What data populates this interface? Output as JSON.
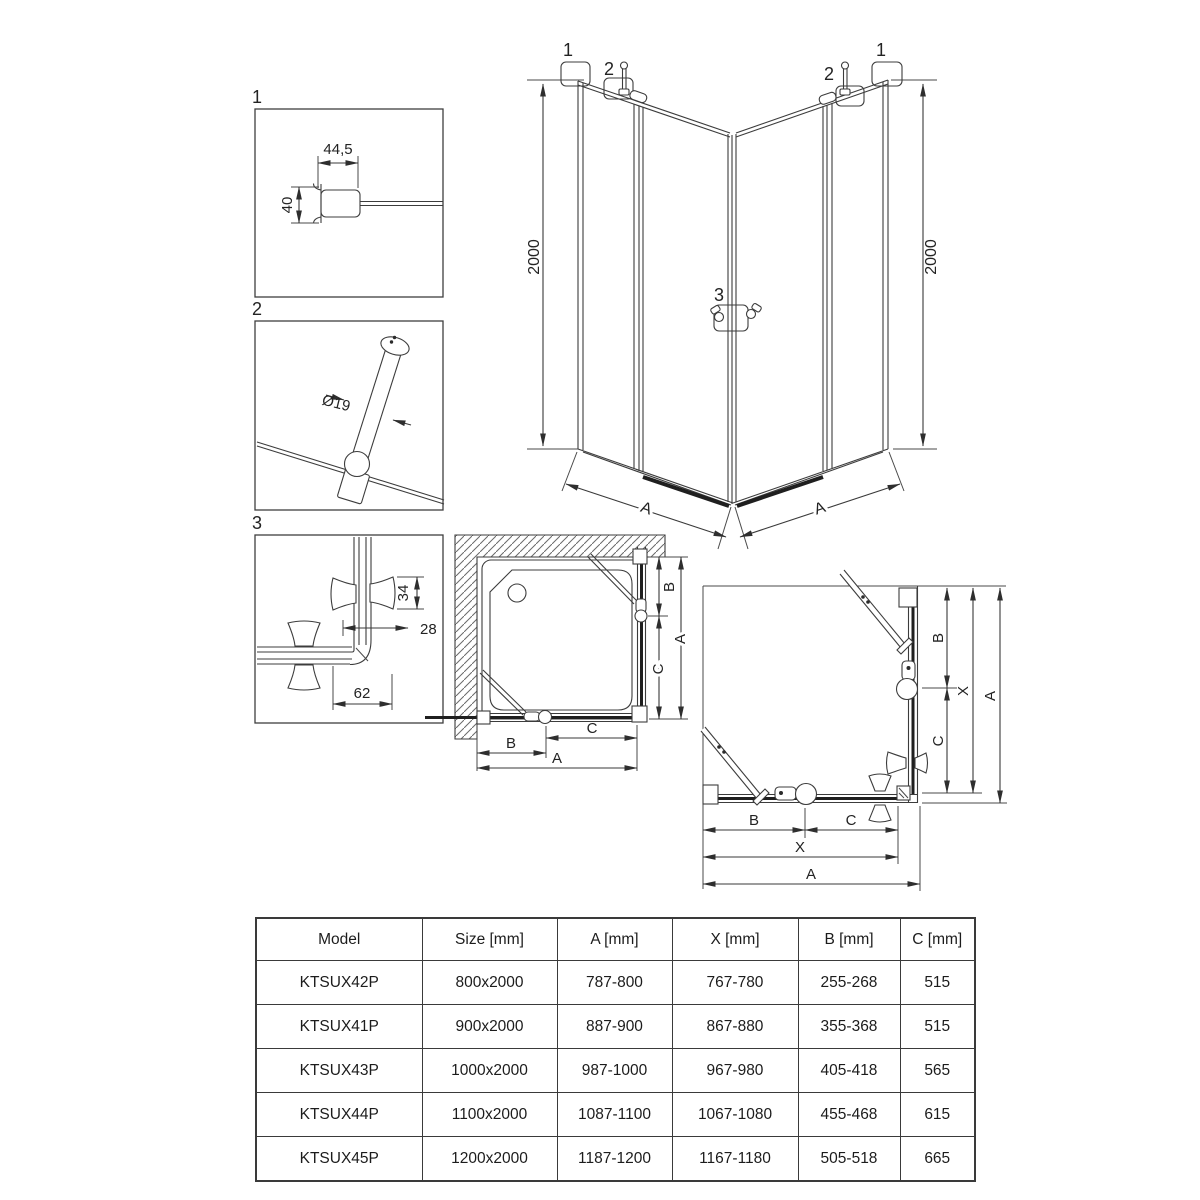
{
  "drawing": {
    "detail_1": {
      "callout": "1",
      "dim_width": "44,5",
      "dim_height": "40"
    },
    "detail_2": {
      "callout": "2",
      "dim_diameter": "Ø19"
    },
    "detail_3": {
      "callout": "3",
      "dim_height": "34",
      "dim_offset": "28",
      "dim_width": "62"
    },
    "elevation": {
      "dim_height_left": "2000",
      "dim_height_right": "2000",
      "dim_width_left": "A",
      "dim_width_right": "A",
      "callout_1_left": "1",
      "callout_2_left": "2",
      "callout_3": "3",
      "callout_2_right": "2",
      "callout_1_right": "1"
    },
    "plan_small": {
      "dim_side_b": "B",
      "dim_side_a": "A",
      "dim_side_c": "C",
      "dim_bottom_b": "B",
      "dim_bottom_c": "C",
      "dim_bottom_a": "A"
    },
    "plan_large": {
      "dim_side_b": "B",
      "dim_side_x": "X",
      "dim_side_a": "A",
      "dim_side_c": "C",
      "dim_bottom_b": "B",
      "dim_bottom_c": "C",
      "dim_bottom_x": "X",
      "dim_bottom_a": "A"
    }
  },
  "table": {
    "headers": [
      "Model",
      "Size [mm]",
      "A [mm]",
      "X [mm]",
      "B [mm]",
      "C [mm]"
    ],
    "rows": [
      [
        "KTSUX42P",
        "800x2000",
        "787-800",
        "767-780",
        "255-268",
        "515"
      ],
      [
        "KTSUX41P",
        "900x2000",
        "887-900",
        "867-880",
        "355-368",
        "515"
      ],
      [
        "KTSUX43P",
        "1000x2000",
        "987-1000",
        "967-980",
        "405-418",
        "565"
      ],
      [
        "KTSUX44P",
        "1100x2000",
        "1087-1100",
        "1067-1080",
        "455-468",
        "615"
      ],
      [
        "KTSUX45P",
        "1200x2000",
        "1187-1200",
        "1167-1180",
        "505-518",
        "665"
      ]
    ]
  }
}
